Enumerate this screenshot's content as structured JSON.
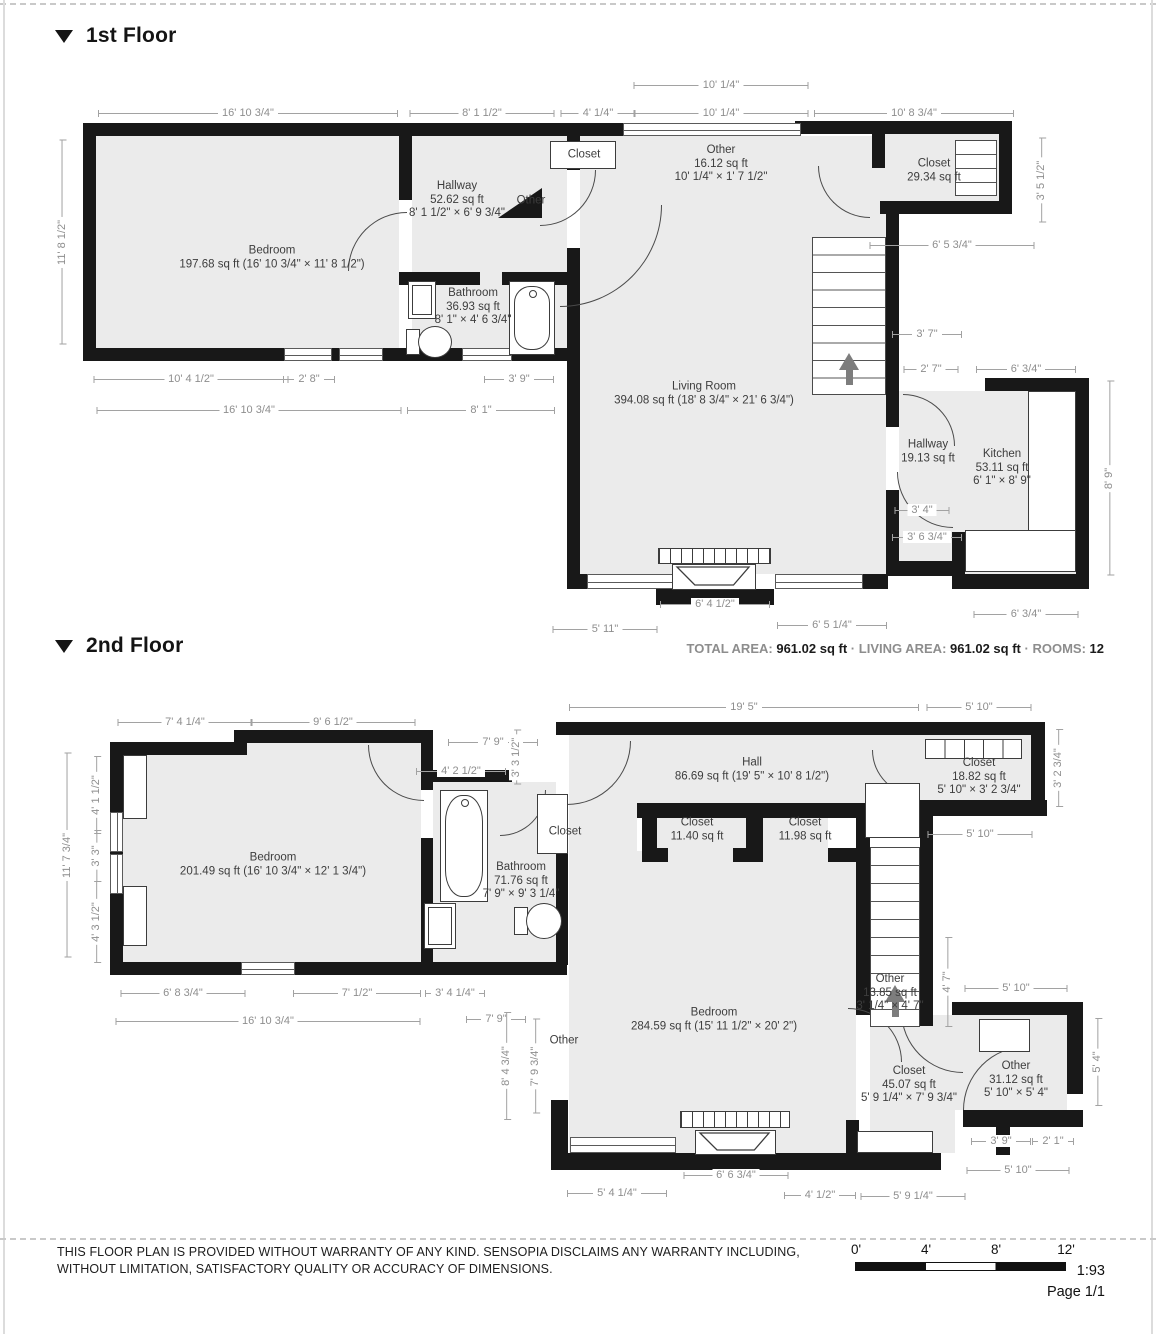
{
  "floor1": {
    "title": "1st Floor",
    "rooms": [
      {
        "name": "Bedroom",
        "lines": [
          "197.68 sq ft (16' 10 3/4\" × 11' 8 1/2\")"
        ],
        "x": 272,
        "y": 258
      },
      {
        "name": "Hallway",
        "lines": [
          "52.62 sq ft",
          "8' 1 1/2\" × 6' 9 3/4\""
        ],
        "x": 457,
        "y": 200
      },
      {
        "name": "Bathroom",
        "lines": [
          "36.93 sq ft",
          "8' 1\" × 4' 6 3/4\""
        ],
        "x": 473,
        "y": 307
      },
      {
        "name": "Closet",
        "lines": [],
        "x": 584,
        "y": 155
      },
      {
        "name": "Other",
        "lines": [],
        "x": 531,
        "y": 201
      },
      {
        "name": "Other",
        "lines": [
          "16.12 sq ft",
          "10' 1/4\" × 1' 7 1/2\""
        ],
        "x": 721,
        "y": 164
      },
      {
        "name": "Closet",
        "lines": [
          "29.34 sq ft"
        ],
        "x": 934,
        "y": 171
      },
      {
        "name": "Living Room",
        "lines": [
          "394.08 sq ft (18' 8 3/4\" × 21' 6 3/4\")"
        ],
        "x": 704,
        "y": 394
      },
      {
        "name": "Hallway",
        "lines": [
          "19.13 sq ft"
        ],
        "x": 928,
        "y": 452
      },
      {
        "name": "Kitchen",
        "lines": [
          "53.11 sq ft",
          "6' 1\" × 8' 9\""
        ],
        "x": 1002,
        "y": 468
      }
    ],
    "dims": [
      {
        "t": "10' 1/4\"",
        "x": 721,
        "y": 85,
        "w": 175
      },
      {
        "t": "16' 10 3/4\"",
        "x": 248,
        "y": 113,
        "w": 300
      },
      {
        "t": "8' 1 1/2\"",
        "x": 482,
        "y": 113,
        "w": 145
      },
      {
        "t": "4' 1/4\"",
        "x": 598,
        "y": 113,
        "w": 75
      },
      {
        "t": "10' 1/4\"",
        "x": 721,
        "y": 113,
        "w": 175
      },
      {
        "t": "10' 8 3/4\"",
        "x": 914,
        "y": 113,
        "w": 200
      },
      {
        "t": "3' 5 1/2\"",
        "x": 1041,
        "y": 180,
        "h": 85,
        "v": 1
      },
      {
        "t": "6' 5 3/4\"",
        "x": 952,
        "y": 245,
        "w": 165
      },
      {
        "t": "11' 8 1/2\"",
        "x": 62,
        "y": 242,
        "h": 205,
        "v": 1
      },
      {
        "t": "3' 7\"",
        "x": 927,
        "y": 334,
        "w": 70
      },
      {
        "t": "2' 7\"",
        "x": 931,
        "y": 369,
        "w": 55
      },
      {
        "t": "6' 3/4\"",
        "x": 1026,
        "y": 369,
        "w": 100
      },
      {
        "t": "8' 9\"",
        "x": 1109,
        "y": 478,
        "h": 195,
        "v": 1
      },
      {
        "t": "3' 4\"",
        "x": 922,
        "y": 510,
        "w": 55
      },
      {
        "t": "3' 6 3/4\"",
        "x": 927,
        "y": 537,
        "w": 70
      },
      {
        "t": "10' 4 1/2\"",
        "x": 191,
        "y": 379,
        "w": 195
      },
      {
        "t": "2' 8\"",
        "x": 309,
        "y": 379,
        "w": 52
      },
      {
        "t": "3' 9\"",
        "x": 519,
        "y": 379,
        "w": 70
      },
      {
        "t": "16' 10 3/4\"",
        "x": 249,
        "y": 410,
        "w": 305
      },
      {
        "t": "8' 1\"",
        "x": 481,
        "y": 410,
        "w": 148
      },
      {
        "t": "6' 4 1/2\"",
        "x": 715,
        "y": 604,
        "w": 110
      },
      {
        "t": "5' 11\"",
        "x": 605,
        "y": 629,
        "w": 105
      },
      {
        "t": "6' 5 1/4\"",
        "x": 832,
        "y": 625,
        "w": 110
      },
      {
        "t": "6' 3/4\"",
        "x": 1026,
        "y": 614,
        "w": 105
      }
    ]
  },
  "floor2": {
    "title": "2nd Floor",
    "rooms": [
      {
        "name": "Bedroom",
        "lines": [
          "201.49 sq ft (16' 10 3/4\" × 12' 1 3/4\")"
        ],
        "x": 273,
        "y": 865
      },
      {
        "name": "Bathroom",
        "lines": [
          "71.76 sq ft",
          "7' 9\" × 9' 3 1/4\""
        ],
        "x": 521,
        "y": 881
      },
      {
        "name": "Closet",
        "lines": [],
        "x": 565,
        "y": 832
      },
      {
        "name": "Hall",
        "lines": [
          "86.69 sq ft (19' 5\" × 10' 8 1/2\")"
        ],
        "x": 752,
        "y": 770
      },
      {
        "name": "Closet",
        "lines": [
          "11.40 sq ft"
        ],
        "x": 697,
        "y": 830
      },
      {
        "name": "Closet",
        "lines": [
          "11.98 sq ft"
        ],
        "x": 805,
        "y": 830
      },
      {
        "name": "Closet",
        "lines": [
          "18.82 sq ft",
          "5' 10\" × 3' 2 3/4\""
        ],
        "x": 979,
        "y": 777
      },
      {
        "name": "Bedroom",
        "lines": [
          "284.59 sq ft (15' 11 1/2\" × 20' 2\")"
        ],
        "x": 714,
        "y": 1020
      },
      {
        "name": "Other",
        "lines": [
          "13.85 sq ft",
          "3' 1/4\" × 4' 7\""
        ],
        "x": 890,
        "y": 993
      },
      {
        "name": "Closet",
        "lines": [
          "45.07 sq ft",
          "5' 9 1/4\" × 7' 9 3/4\""
        ],
        "x": 909,
        "y": 1085
      },
      {
        "name": "Other",
        "lines": [
          "31.12 sq ft",
          "5' 10\" × 5' 4\""
        ],
        "x": 1016,
        "y": 1080
      },
      {
        "name": "Other",
        "lines": [],
        "x": 564,
        "y": 1041
      }
    ],
    "dims": [
      {
        "t": "7' 4 1/4\"",
        "x": 185,
        "y": 722,
        "w": 135
      },
      {
        "t": "9' 6 1/2\"",
        "x": 333,
        "y": 722,
        "w": 165
      },
      {
        "t": "19' 5\"",
        "x": 744,
        "y": 707,
        "w": 350
      },
      {
        "t": "5' 10\"",
        "x": 979,
        "y": 707,
        "w": 105
      },
      {
        "t": "7' 9\"",
        "x": 493,
        "y": 742,
        "w": 90
      },
      {
        "t": "3' 3 1/2\"",
        "x": 516,
        "y": 757,
        "h": 55,
        "v": 1
      },
      {
        "t": "4' 2 1/2\"",
        "x": 461,
        "y": 771,
        "w": 90
      },
      {
        "t": "3' 2 3/4\"",
        "x": 1058,
        "y": 768,
        "h": 78,
        "v": 1
      },
      {
        "t": "5' 10\"",
        "x": 980,
        "y": 834,
        "w": 105
      },
      {
        "t": "11' 7 3/4\"",
        "x": 67,
        "y": 855,
        "h": 205,
        "v": 1
      },
      {
        "t": "4' 1 1/2\"",
        "x": 96,
        "y": 795,
        "h": 78,
        "v": 1
      },
      {
        "t": "3' 3\"",
        "x": 96,
        "y": 856,
        "h": 52,
        "v": 1
      },
      {
        "t": "4' 3 1/2\"",
        "x": 96,
        "y": 922,
        "h": 82,
        "v": 1
      },
      {
        "t": "4' 7\"",
        "x": 947,
        "y": 982,
        "h": 90,
        "v": 1
      },
      {
        "t": "5' 10\"",
        "x": 1016,
        "y": 988,
        "w": 103
      },
      {
        "t": "5' 4\"",
        "x": 1097,
        "y": 1062,
        "h": 88,
        "v": 1
      },
      {
        "t": "6' 8 3/4\"",
        "x": 183,
        "y": 993,
        "w": 125
      },
      {
        "t": "7' 1/2\"",
        "x": 357,
        "y": 993,
        "w": 128
      },
      {
        "t": "3' 4 1/4\"",
        "x": 455,
        "y": 993,
        "w": 60
      },
      {
        "t": "16' 10 3/4\"",
        "x": 268,
        "y": 1021,
        "w": 305
      },
      {
        "t": "7' 9\"",
        "x": 496,
        "y": 1019,
        "w": 60
      },
      {
        "t": "8' 4 3/4\"",
        "x": 506,
        "y": 1066,
        "h": 108,
        "v": 1
      },
      {
        "t": "7' 9 3/4\"",
        "x": 535,
        "y": 1066,
        "h": 95,
        "v": 1
      },
      {
        "t": "5' 4 1/4\"",
        "x": 617,
        "y": 1193,
        "w": 100
      },
      {
        "t": "6' 6 3/4\"",
        "x": 736,
        "y": 1175,
        "w": 105
      },
      {
        "t": "4' 1/2\"",
        "x": 820,
        "y": 1195,
        "w": 72
      },
      {
        "t": "5' 9 1/4\"",
        "x": 913,
        "y": 1196,
        "w": 105
      },
      {
        "t": "3' 9\"",
        "x": 1001,
        "y": 1141,
        "w": 60
      },
      {
        "t": "2' 1\"",
        "x": 1053,
        "y": 1141,
        "w": 42
      },
      {
        "t": "5' 10\"",
        "x": 1018,
        "y": 1170,
        "w": 103
      }
    ]
  },
  "summary": {
    "total_label": "TOTAL AREA:",
    "total_value": "961.02 sq ft",
    "sep1": "·",
    "living_label": "LIVING AREA:",
    "living_value": "961.02 sq ft",
    "sep2": "·",
    "rooms_label": "ROOMS:",
    "rooms_value": "12"
  },
  "footer": {
    "disclaimer1": "THIS FLOOR PLAN IS PROVIDED WITHOUT WARRANTY OF ANY KIND. SENSOPIA DISCLAIMS ANY WARRANTY INCLUDING,",
    "disclaimer2": "WITHOUT LIMITATION, SATISFACTORY QUALITY OR ACCURACY OF DIMENSIONS.",
    "scale_ticks": [
      "0'",
      "4'",
      "8'",
      "12'"
    ],
    "scale_ratio": "1:93",
    "page_label": "Page 1/1"
  }
}
